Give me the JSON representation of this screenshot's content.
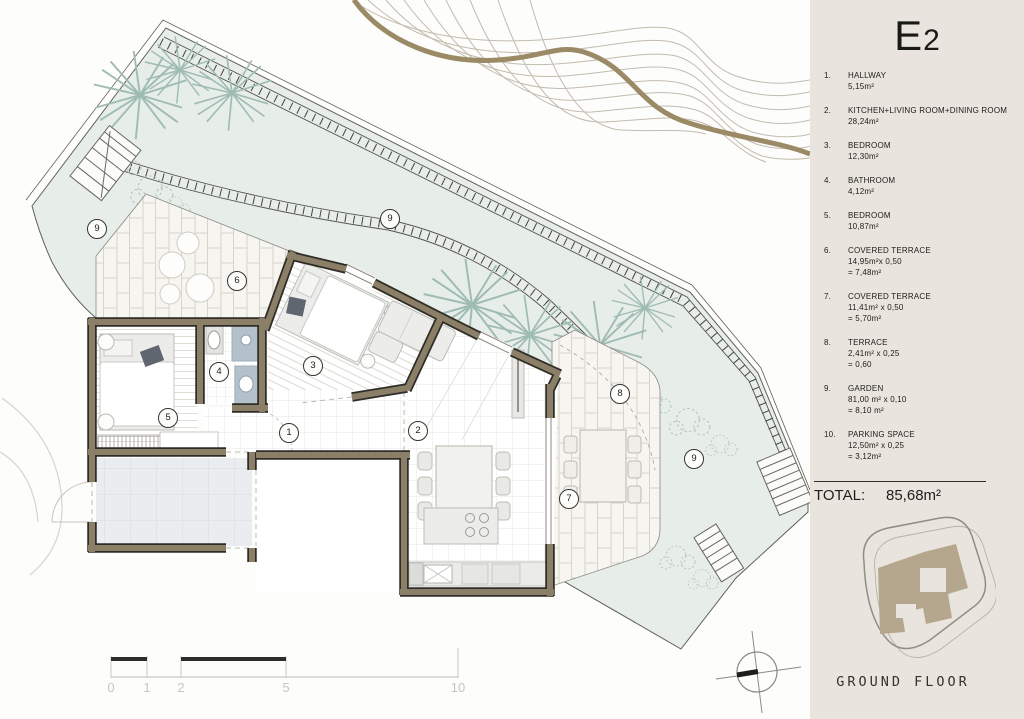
{
  "sidebar": {
    "title": {
      "main": "E",
      "sub": "2"
    },
    "legend": [
      {
        "num": "1.",
        "label": "HALLWAY",
        "line2": "5,15m²",
        "line3": ""
      },
      {
        "num": "2.",
        "label": "KITCHEN+LIVING ROOM+DINING ROOM",
        "line2": "28,24m²",
        "line3": ""
      },
      {
        "num": "3.",
        "label": "BEDROOM",
        "line2": "12,30m²",
        "line3": ""
      },
      {
        "num": "4.",
        "label": "BATHROOM",
        "line2": "4,12m²",
        "line3": ""
      },
      {
        "num": "5.",
        "label": "BEDROOM",
        "line2": "10,87m²",
        "line3": ""
      },
      {
        "num": "6.",
        "label": "COVERED TERRACE",
        "line2": "14,95m²x 0,50",
        "line3": "= 7,48m²"
      },
      {
        "num": "7.",
        "label": "COVERED TERRACE",
        "line2": "11,41m² x 0,50",
        "line3": "= 5,70m²"
      },
      {
        "num": "8.",
        "label": "TERRACE",
        "line2": "2,41m² x 0,25",
        "line3": "= 0,60"
      },
      {
        "num": "9.",
        "label": "GARDEN",
        "line2": "81,00 m² x 0,10",
        "line3": "= 8,10 m²"
      },
      {
        "num": "10.",
        "label": "PARKING SPACE",
        "line2": "12,50m² x 0,25",
        "line3": "= 3,12m²"
      }
    ],
    "total_label": "TOTAL:",
    "total_value": "85,68m²",
    "footprint_caption": "GROUND FLOOR"
  },
  "plan": {
    "room_labels": [
      {
        "n": "1",
        "x": 288,
        "y": 432
      },
      {
        "n": "2",
        "x": 417,
        "y": 430
      },
      {
        "n": "3",
        "x": 312,
        "y": 365
      },
      {
        "n": "4",
        "x": 218,
        "y": 371
      },
      {
        "n": "5",
        "x": 167,
        "y": 417
      },
      {
        "n": "6",
        "x": 236,
        "y": 280
      },
      {
        "n": "7",
        "x": 568,
        "y": 498
      },
      {
        "n": "8",
        "x": 619,
        "y": 393
      },
      {
        "n": "9",
        "x": 96,
        "y": 228
      },
      {
        "n": "9",
        "x": 389,
        "y": 218
      },
      {
        "n": "9",
        "x": 693,
        "y": 458
      }
    ],
    "scale_ticks": [
      {
        "t": "0",
        "x": 111
      },
      {
        "t": "1",
        "x": 147
      },
      {
        "t": "2",
        "x": 181
      },
      {
        "t": "5",
        "x": 286
      },
      {
        "t": "10",
        "x": 458
      }
    ],
    "colors": {
      "garden": "#e7ede8",
      "wall": "#8b7f68",
      "wall_outline": "#2e2d28",
      "terrace_paving": "#f7f5f0",
      "parking": "#e9edf0",
      "bath_tile": "#b4c1cb",
      "contour_accent": "#9b8a66",
      "sidebar_bg": "#e9e5de",
      "footprint_fill": "#b4a78d"
    }
  }
}
